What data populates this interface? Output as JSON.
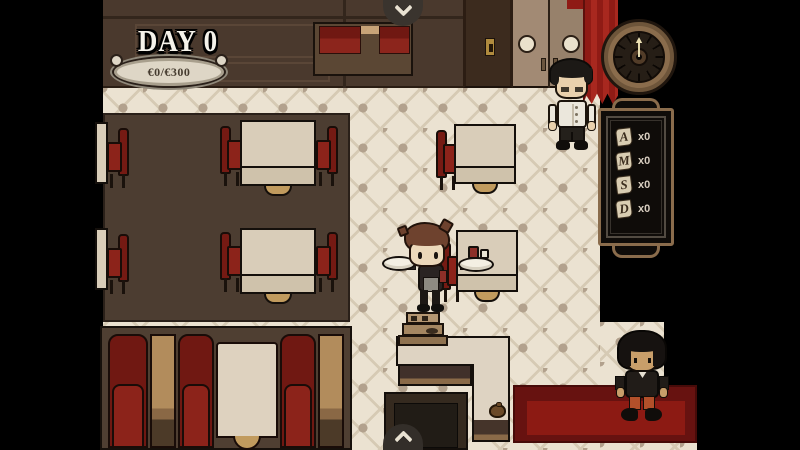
{
  "hud": {
    "day_label": "DAY 0",
    "money_counter": "€0/€300"
  },
  "menu_board": {
    "items": [
      {
        "letter": "A",
        "count": "x0"
      },
      {
        "letter": "M",
        "count": "x0"
      },
      {
        "letter": "S",
        "count": "x0"
      },
      {
        "letter": "D",
        "count": "x0"
      }
    ]
  },
  "clock": {
    "hand_pointing_to": "12"
  },
  "icons": {
    "top_tab": "chevron-down-icon",
    "bottom_tab": "chevron-up-icon"
  },
  "colors": {
    "accent_red": "#8c231a",
    "carpet_red": "#8c1a13",
    "wood_brown": "#4a392d",
    "tile_cream": "#ebe2d1",
    "hud_text": "#f5f2ea"
  }
}
